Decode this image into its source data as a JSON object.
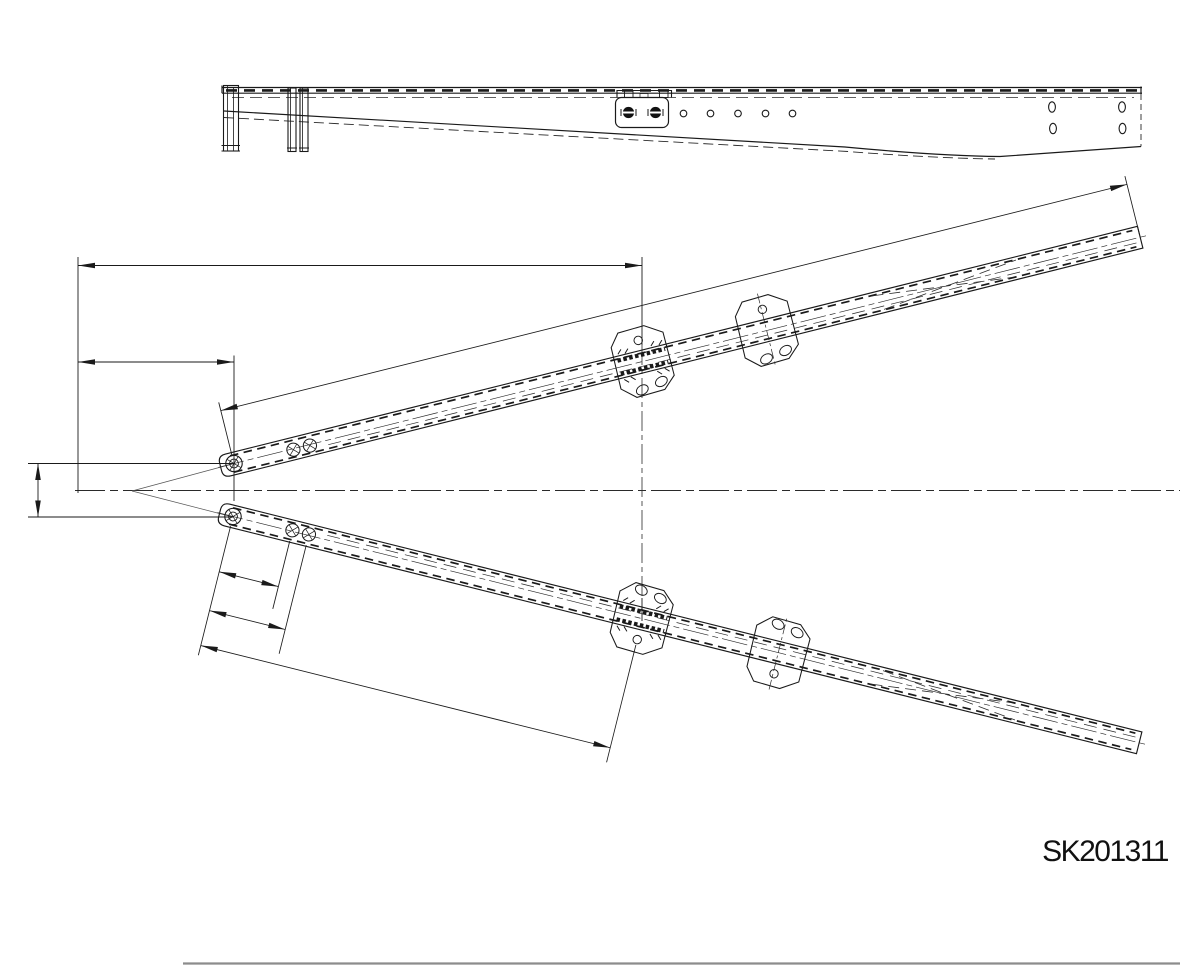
{
  "drawing": {
    "part_number": "SK201311"
  },
  "colors": {
    "line": "#1a1a1a",
    "thin_line": "#2a2a2a",
    "border_line": "#8c8c8c",
    "background": "#ffffff"
  },
  "views": {
    "side_view": {
      "small_holes_count": 5,
      "slotted_holes_count": 4,
      "black_bolts_count": 2,
      "brackets_count": 2
    },
    "plan_view": {
      "arms_count": 2,
      "clamp_plates_per_arm": 2,
      "tip_bolts_per_arm": 3,
      "unlabeled_dimensions_count": 7
    }
  }
}
